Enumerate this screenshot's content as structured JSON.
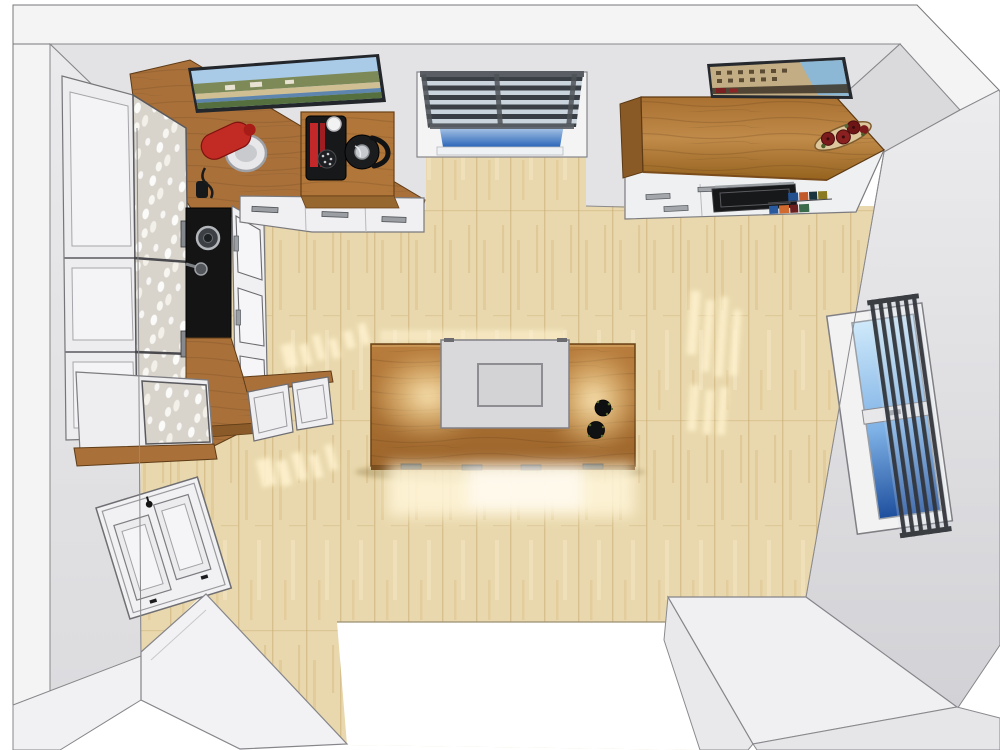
{
  "title": "Kitchen top-down 3D render",
  "palette": {
    "wall": "#e3e3e5",
    "wall_left": "#e8e8ea",
    "wall_shaded": "#d8d8db",
    "wall_cut": "#f4f4f5",
    "outline": "#77777b",
    "floor": "#e9d8ad",
    "sun": "#fff3cf",
    "counter_wood": "#a9703a",
    "canopy_wood": "#b07634",
    "island_wood": "#b2763a",
    "wood_edge": "#6b4316",
    "cabinet_white": "#f0f0f2",
    "appliance_black": "#141414",
    "hood_gray": "#d9d9db",
    "glass_sky_light": "#dff0fb",
    "glass_sky_deep": "#2a66b8",
    "blind_slat": "#3a3f46",
    "mixer_red": "#c22a24",
    "flower_red": "#7c1b1b",
    "tray_tan": "#dcc89c"
  },
  "objects": {
    "room": {
      "label": "kitchen room seen from above"
    },
    "floor": {
      "label": "light oak plank floor"
    },
    "picture_left": {
      "label": "coastal landscape wall art"
    },
    "picture_right": {
      "label": "colosseum wall art"
    },
    "window_top": {
      "label": "window with venetian blinds"
    },
    "window_right": {
      "label": "window with blinds"
    },
    "tall_cabinets": {
      "label": "tall white display cabinets with glassware"
    },
    "sink": {
      "label": "black sink with faucet"
    },
    "base_left": {
      "label": "white framed base cabinets"
    },
    "end_cabinet": {
      "label": "display cabinet end unit"
    },
    "corner_counter": {
      "label": "wood corner countertop"
    },
    "mixer": {
      "label": "red stand mixer with bowl"
    },
    "coffee_station": {
      "label": "wood coffee station block"
    },
    "coffee_machine": {
      "label": "coffee machine"
    },
    "kettle": {
      "label": "black electric kettle"
    },
    "drawer_run": {
      "label": "drawer base cabinets"
    },
    "canopy": {
      "label": "wood canopy shelf"
    },
    "flower_tray": {
      "label": "tray with red flowers"
    },
    "oven_run": {
      "label": "base cabinets with built-in oven"
    },
    "oven": {
      "label": "built-in black oven"
    },
    "books": {
      "label": "cookbooks on shelf"
    },
    "island": {
      "label": "kitchen island with wood worktop"
    },
    "hood": {
      "label": "island extractor hood"
    },
    "bowls": {
      "label": "two black herb bowls"
    },
    "door": {
      "label": "white panel door"
    },
    "slab_left": {
      "label": "cut wall segment left"
    },
    "slab_right": {
      "label": "cut wall segment right"
    },
    "doorway": {
      "label": "doorway opening"
    },
    "sunlight": {
      "label": "sunlight patches on floor"
    }
  }
}
